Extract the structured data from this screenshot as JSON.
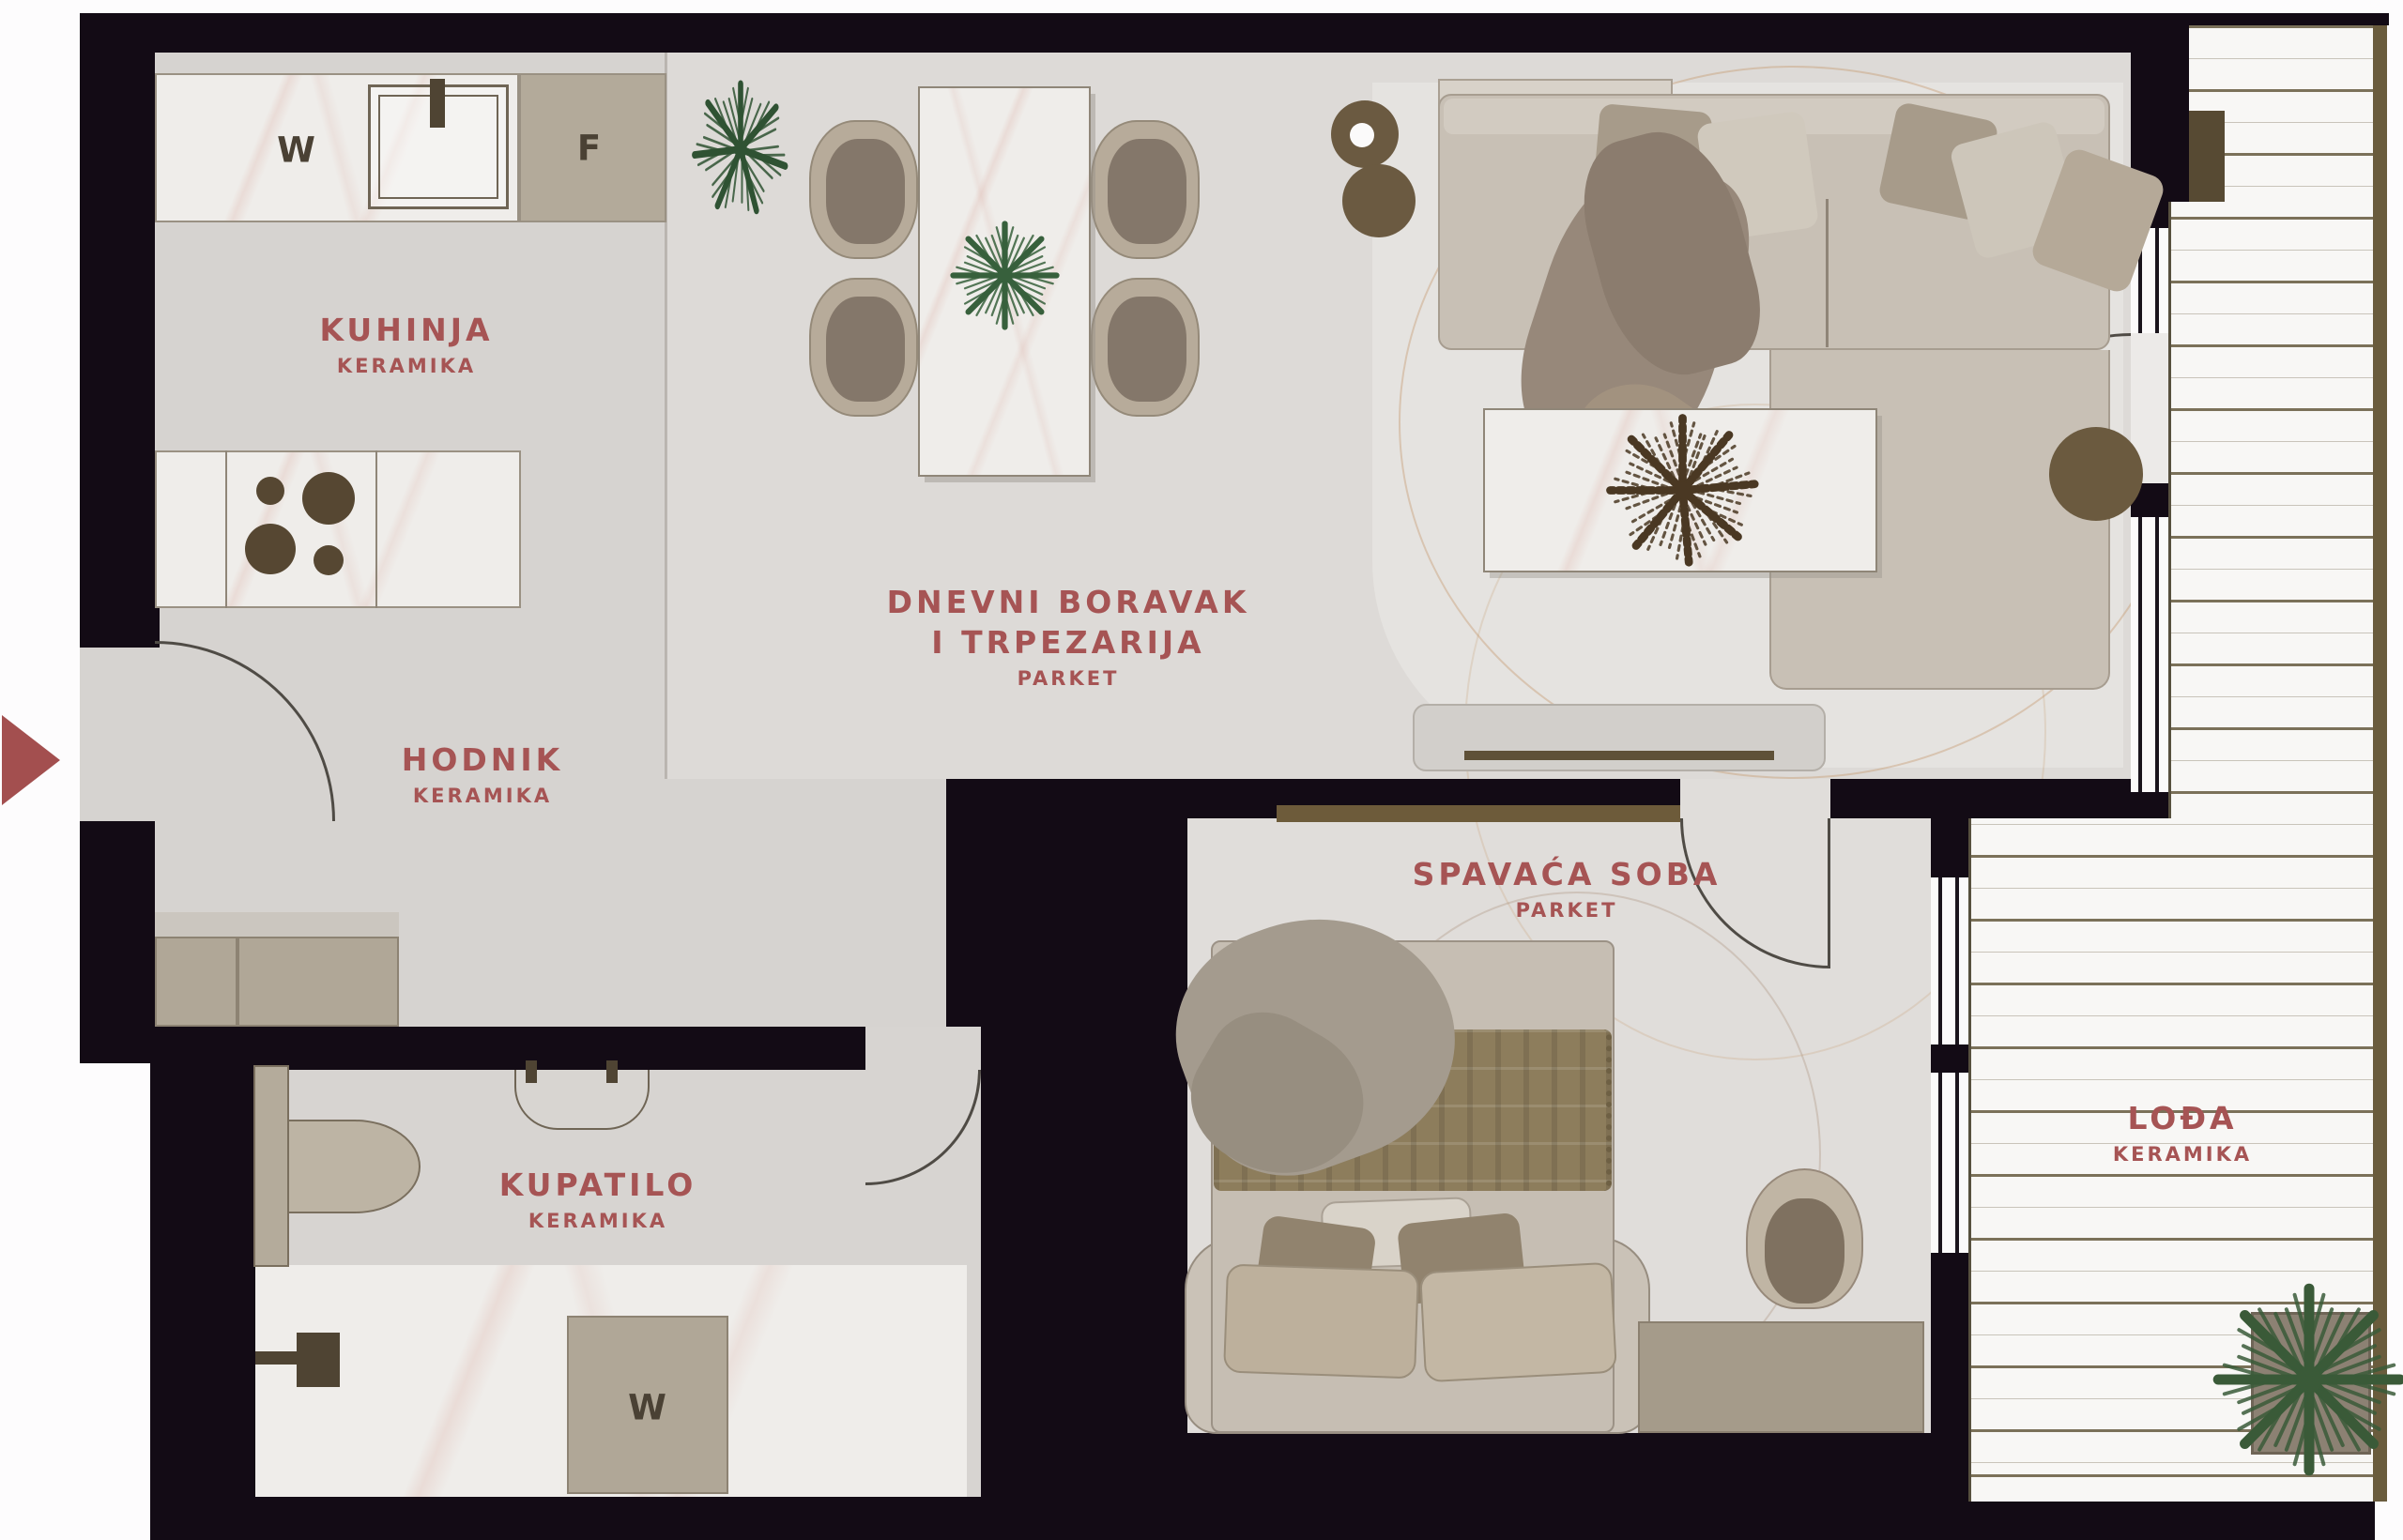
{
  "title": "Apartment floor plan",
  "rooms": [
    {
      "id": "kuhinja",
      "name": "KUHINJA",
      "material": "KERAMIKA"
    },
    {
      "id": "hodnik",
      "name": "HODNIK",
      "material": "KERAMIKA"
    },
    {
      "id": "dnevni",
      "name": "DNEVNI BORAVAK",
      "name2": "I TRPEZARIJA",
      "material": "PARKET"
    },
    {
      "id": "spavaca",
      "name": "SPAVAĆA SOBA",
      "material": "PARKET"
    },
    {
      "id": "kupatilo",
      "name": "KUPATILO",
      "material": "KERAMIKA"
    },
    {
      "id": "lodja",
      "name": "LOĐA",
      "material": "KERAMIKA"
    }
  ],
  "appliances": {
    "kitchen_washer": "W",
    "kitchen_fridge": "F",
    "bathroom_washer": "W"
  },
  "colors": {
    "wall": "#130b15",
    "floor": "#dddad7",
    "room_label": "#a65454",
    "entry_arrow": "#a34f4f",
    "cabinet_beige": "#b0a797",
    "wood_brown": "#6d5b3a",
    "plant_green": "#37603c"
  },
  "furniture": [
    "kitchen-counter",
    "kitchen-sink",
    "cooktop",
    "fridge",
    "dining-table",
    "dining-chairs",
    "table-plant",
    "sofa",
    "sofa-cushions",
    "throw-blanket",
    "coffee-table",
    "dried-plant",
    "side-table",
    "floor-lamp",
    "tv-stand",
    "rug",
    "double-bed",
    "pillows",
    "bed-blanket",
    "wardrobe",
    "armchair",
    "dresser",
    "hall-closet",
    "toilet",
    "shower",
    "bathroom-sink",
    "washing-machine",
    "loggia-plant",
    "entrance-arrow"
  ]
}
